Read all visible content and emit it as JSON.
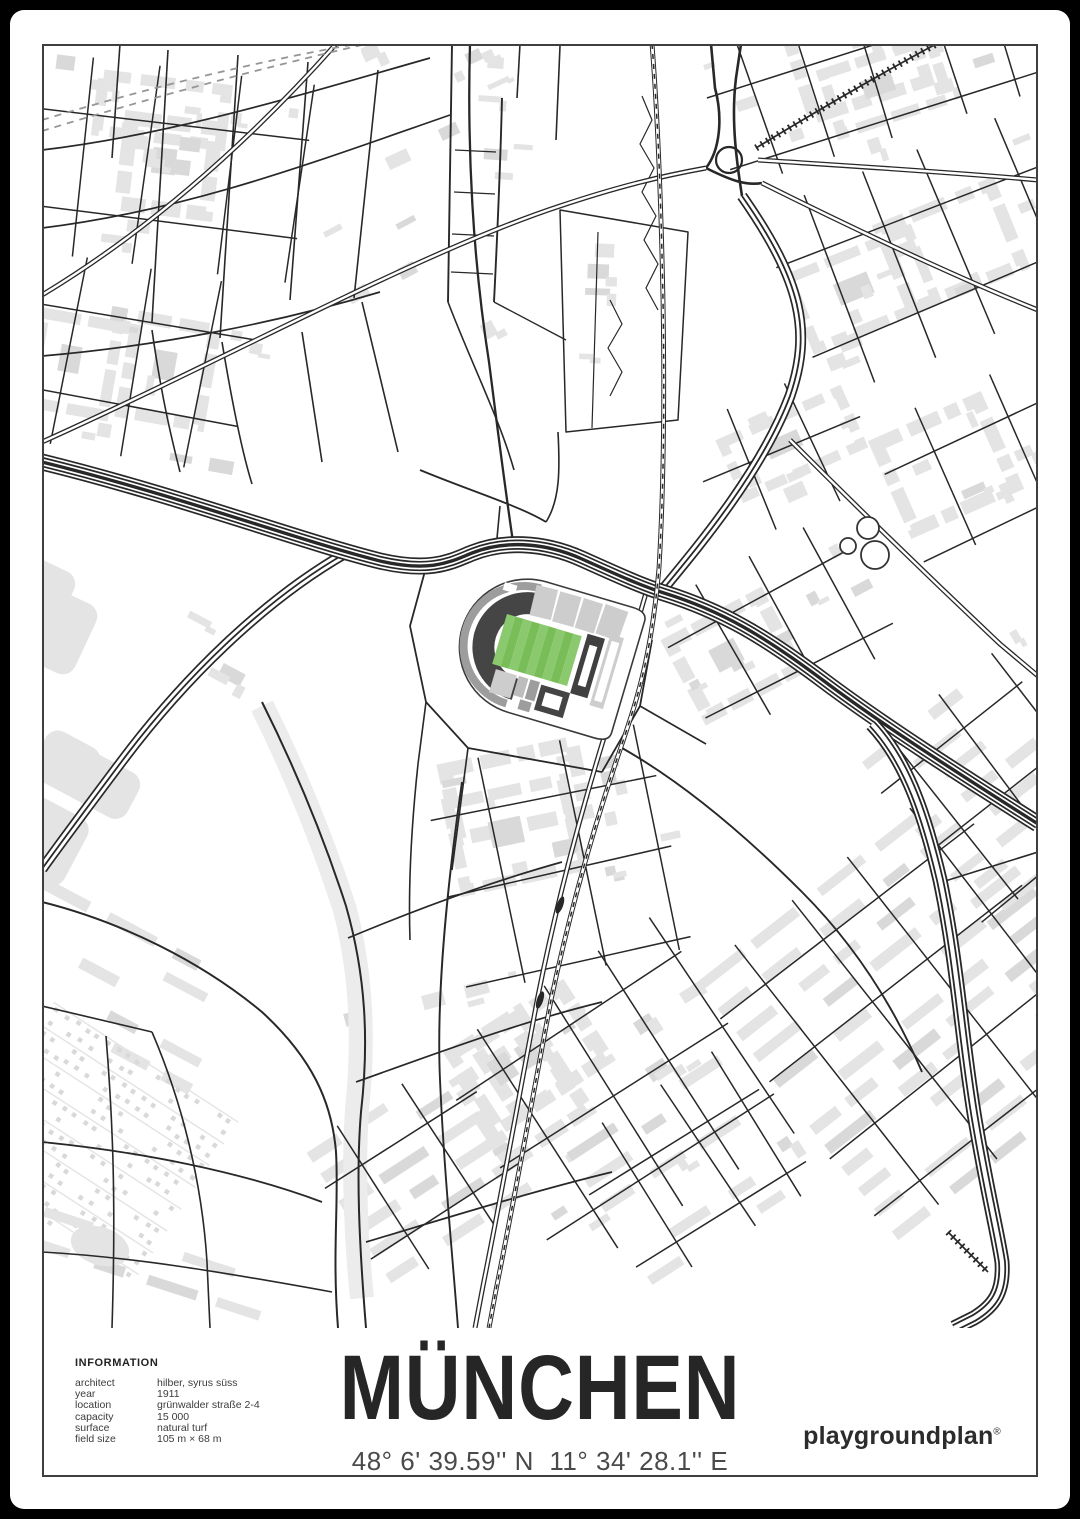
{
  "poster": {
    "title": "MÜNCHEN",
    "coordinates": "48° 6' 39.59'' N  11° 34' 28.1'' E",
    "brand": "playgroundplan",
    "brand_registered": "®"
  },
  "information": {
    "header": "INFORMATION",
    "rows": [
      {
        "label": "architect",
        "value": "hilber, syrus süss"
      },
      {
        "label": "year",
        "value": "1911"
      },
      {
        "label": "location",
        "value": "grünwalder straße 2-4"
      },
      {
        "label": "capacity",
        "value": "15 000"
      },
      {
        "label": "surface",
        "value": "natural turf"
      },
      {
        "label": "field size",
        "value": "105 m × 68 m"
      }
    ]
  },
  "map": {
    "landmark": "stadium",
    "colors": {
      "background": "#ffffff",
      "building": "#e4e4e4",
      "building_dark": "#d9d9d9",
      "park_ribbon": "#ececec",
      "road": "#282828",
      "rail_dash_gray": "#969696",
      "pitch_light": "#8bc96e",
      "pitch_dark": "#79bd59",
      "stand_dark": "#454545",
      "stand_mid": "#9d9d9d",
      "stand_light": "#cdcdcd",
      "frame": "#3f3f3f",
      "poster_background": "#000000"
    }
  }
}
